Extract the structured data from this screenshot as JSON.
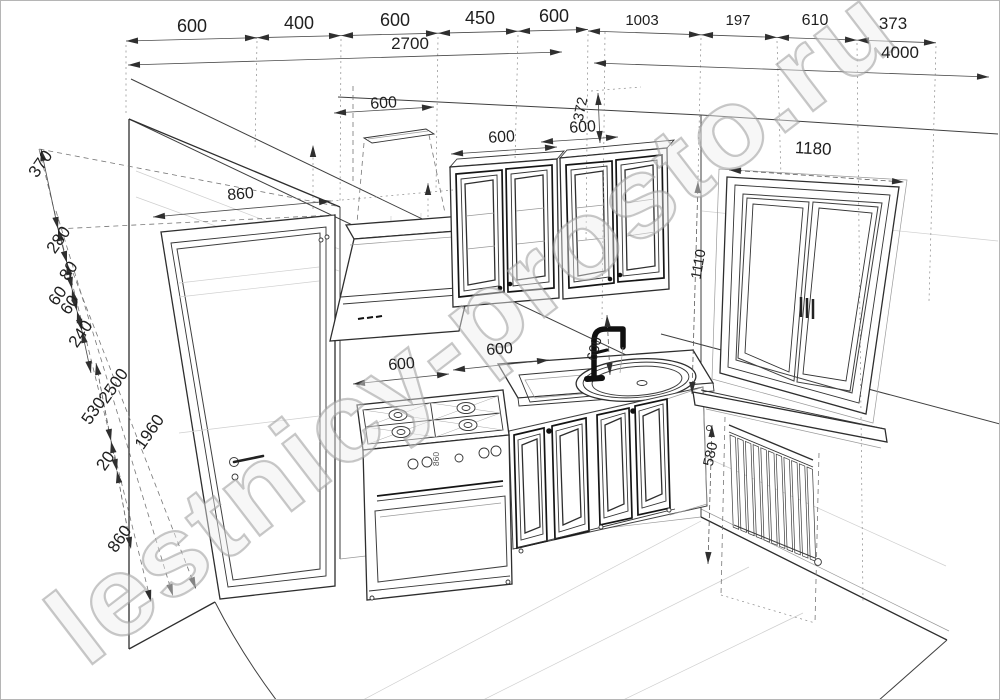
{
  "watermark": "lestnicy-prosto.ru",
  "drawing_title": "kitchen-perspective-blueprint",
  "colors": {
    "background": "#ffffff",
    "line": "#3f3f3f",
    "dark_frame": "#141414",
    "dimension": "#4a4a4a",
    "light_construction": "#cfcfcf",
    "watermark": "#9b9b9b",
    "faucet": "#111111"
  },
  "dimensions": {
    "top_left_chain": [
      "600",
      "400",
      "600",
      "450",
      "600"
    ],
    "top_left_total": "2700",
    "top_right_chain": [
      "1003",
      "197",
      "610",
      "373"
    ],
    "top_right_total": "4000",
    "left_chain": [
      "370",
      "280",
      "80",
      "60",
      "60",
      "240"
    ],
    "left_outer": [
      "2500",
      "530",
      "1960",
      "20",
      "860"
    ],
    "door_width": "860",
    "ceiling_vent_offset": "600",
    "wall_cabinet_1_width": "600",
    "wall_cabinet_2_width": "600",
    "wall_cabinet_height": "372",
    "base_left_width": "600",
    "base_mid_width": "600",
    "faucet_height": "600",
    "stove_marking": "860",
    "window_width": "1180",
    "window_height": "1110",
    "radiator_height": "580"
  }
}
